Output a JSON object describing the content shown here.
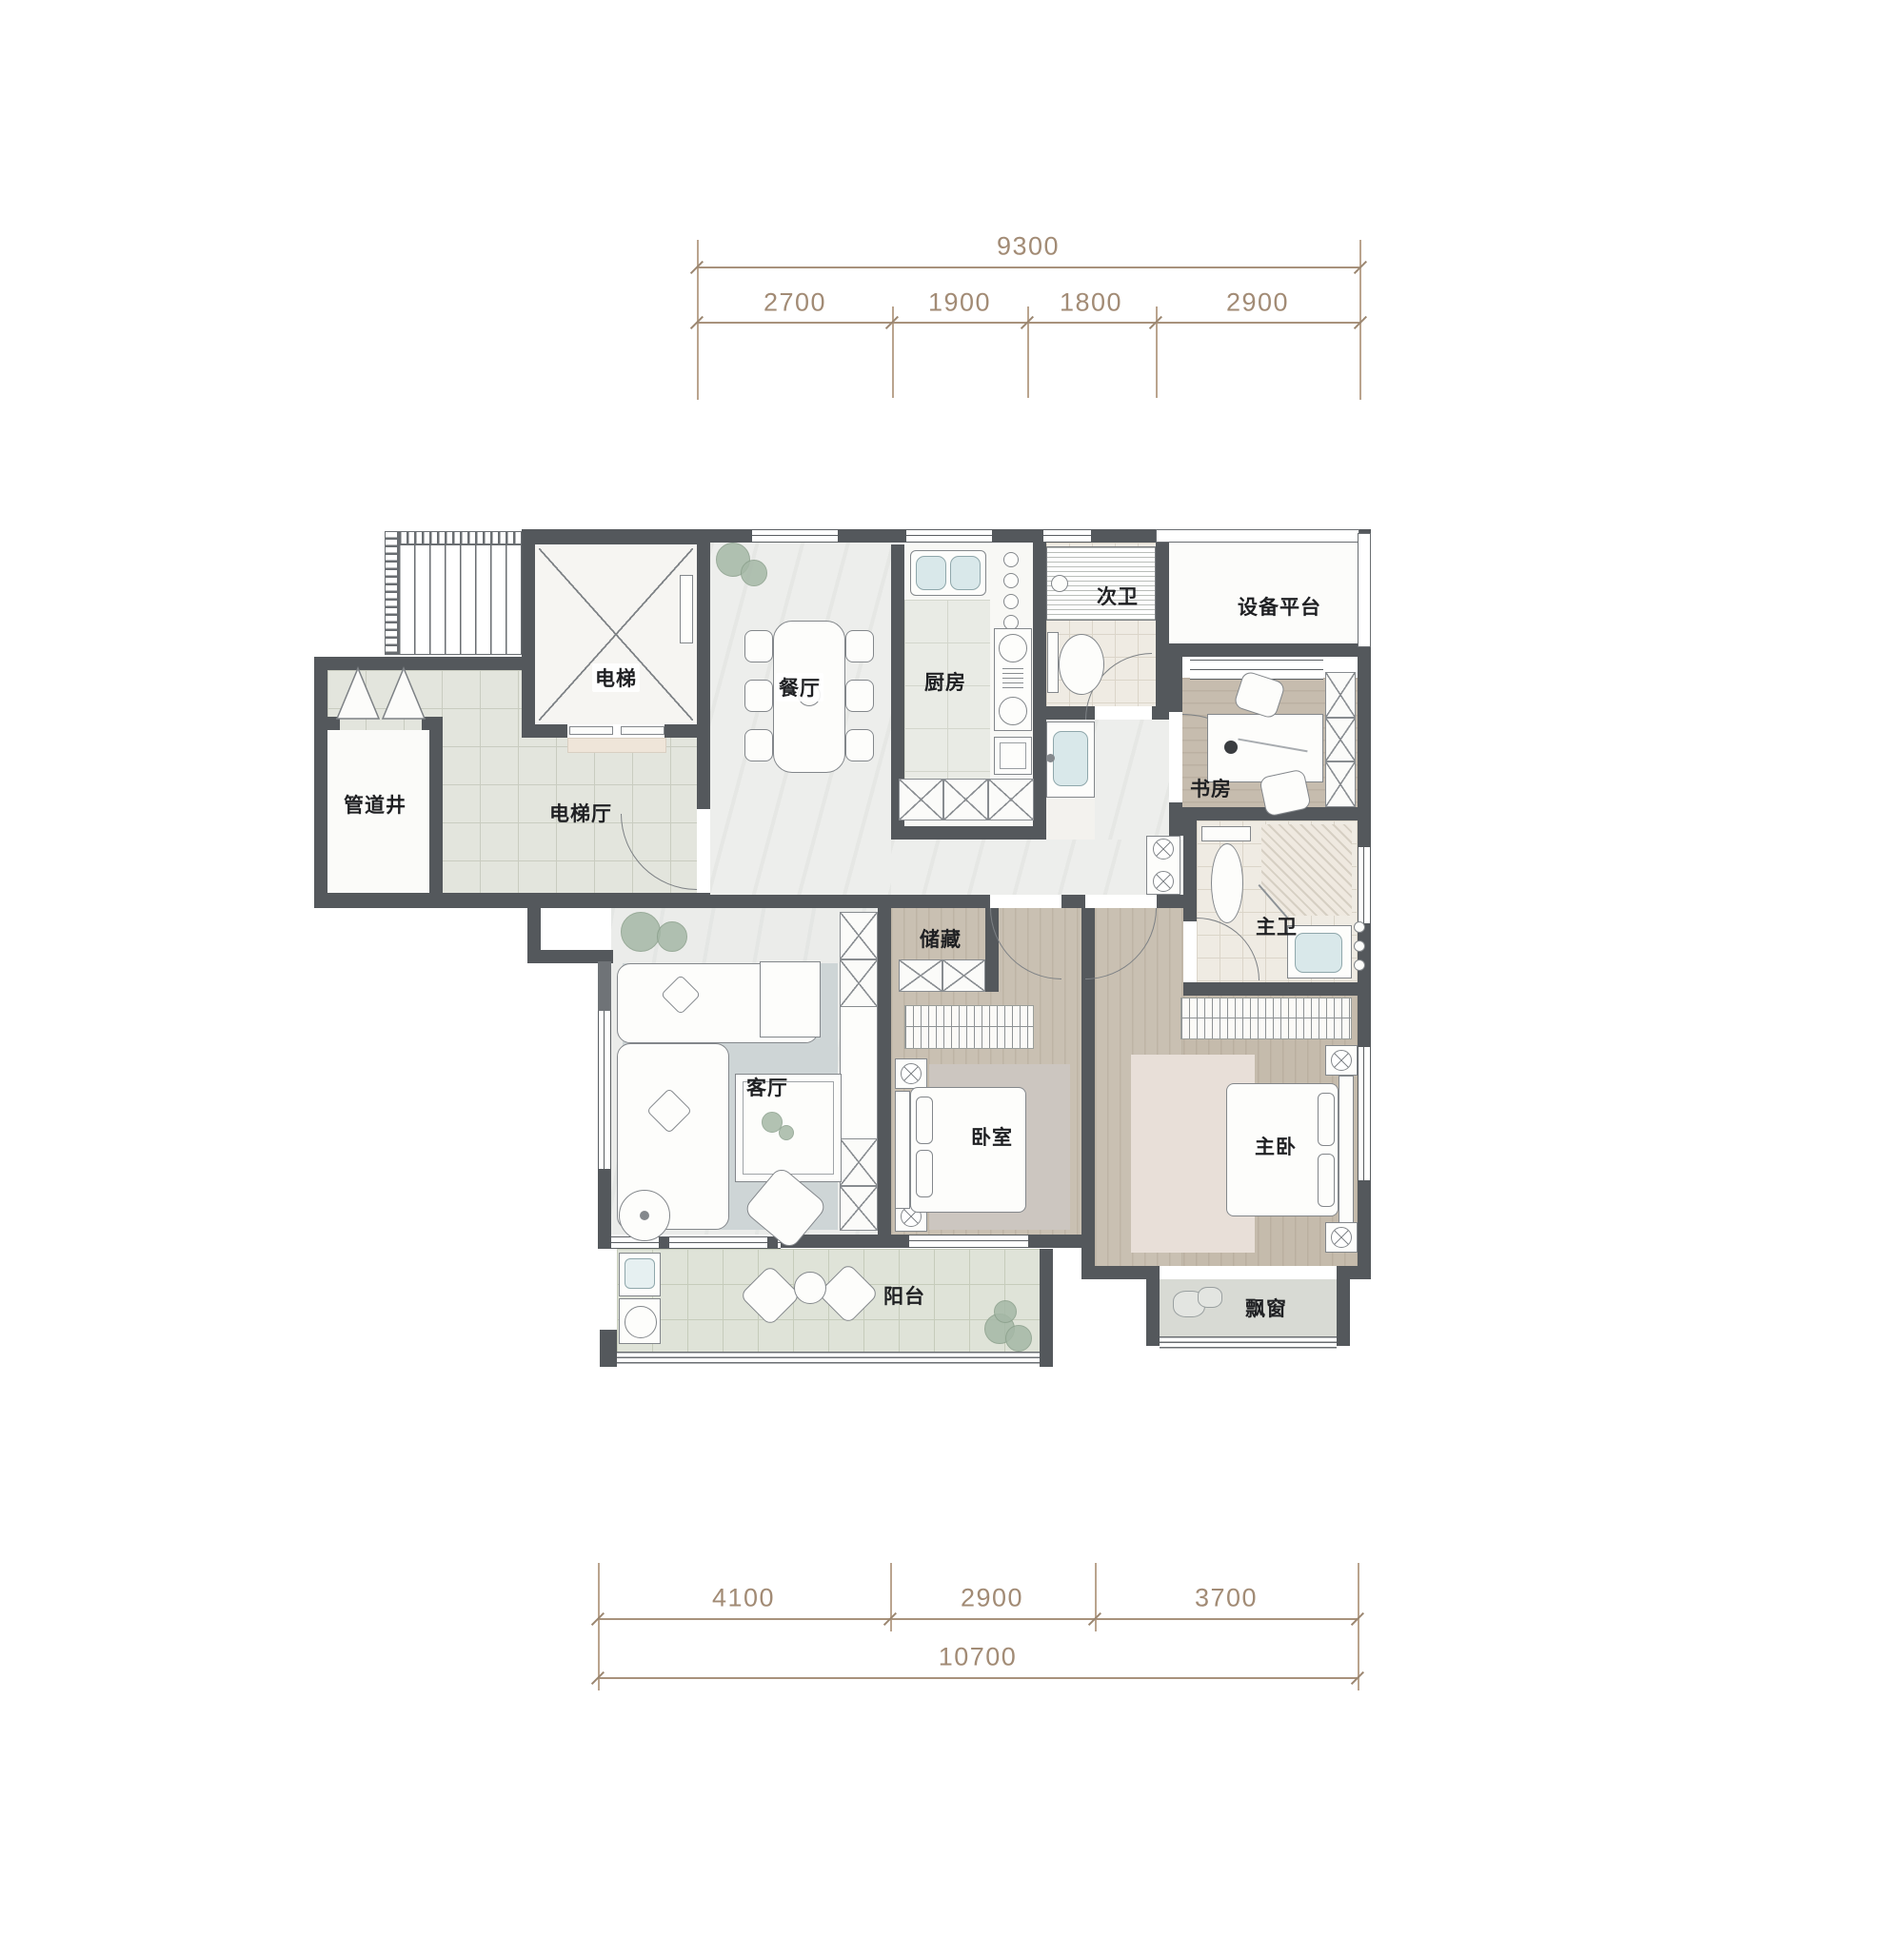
{
  "dimensions": {
    "top": {
      "total": "9300",
      "segments": [
        "2700",
        "1900",
        "1800",
        "2900"
      ]
    },
    "bottom": {
      "total": "10700",
      "segments": [
        "4100",
        "2900",
        "3700"
      ]
    }
  },
  "rooms": {
    "elevator": "电梯",
    "pipe_shaft": "管道井",
    "elevator_hall": "电梯厅",
    "dining": "餐厅",
    "kitchen": "厨房",
    "bath2": "次卫",
    "equipment": "设备平台",
    "study": "书房",
    "master_bath": "主卫",
    "storage": "储藏",
    "living": "客厅",
    "bedroom": "卧室",
    "master_bedroom": "主卧",
    "balcony": "阳台",
    "bay_window": "飘窗"
  },
  "icons": {
    "ceiling_lamp": "circle-with-x",
    "elevator_cross": "x-cross",
    "pipe_shaft_doors": "double-swing-triangles"
  },
  "palette": {
    "wall": "#54585c",
    "dimension": "#a8927c",
    "wood_floor": "#c9c0b2",
    "hall_tile": "#e3e5dd",
    "marble": "#edeeec",
    "basin": "#d9e8ea",
    "rug": "#ced5d6"
  }
}
